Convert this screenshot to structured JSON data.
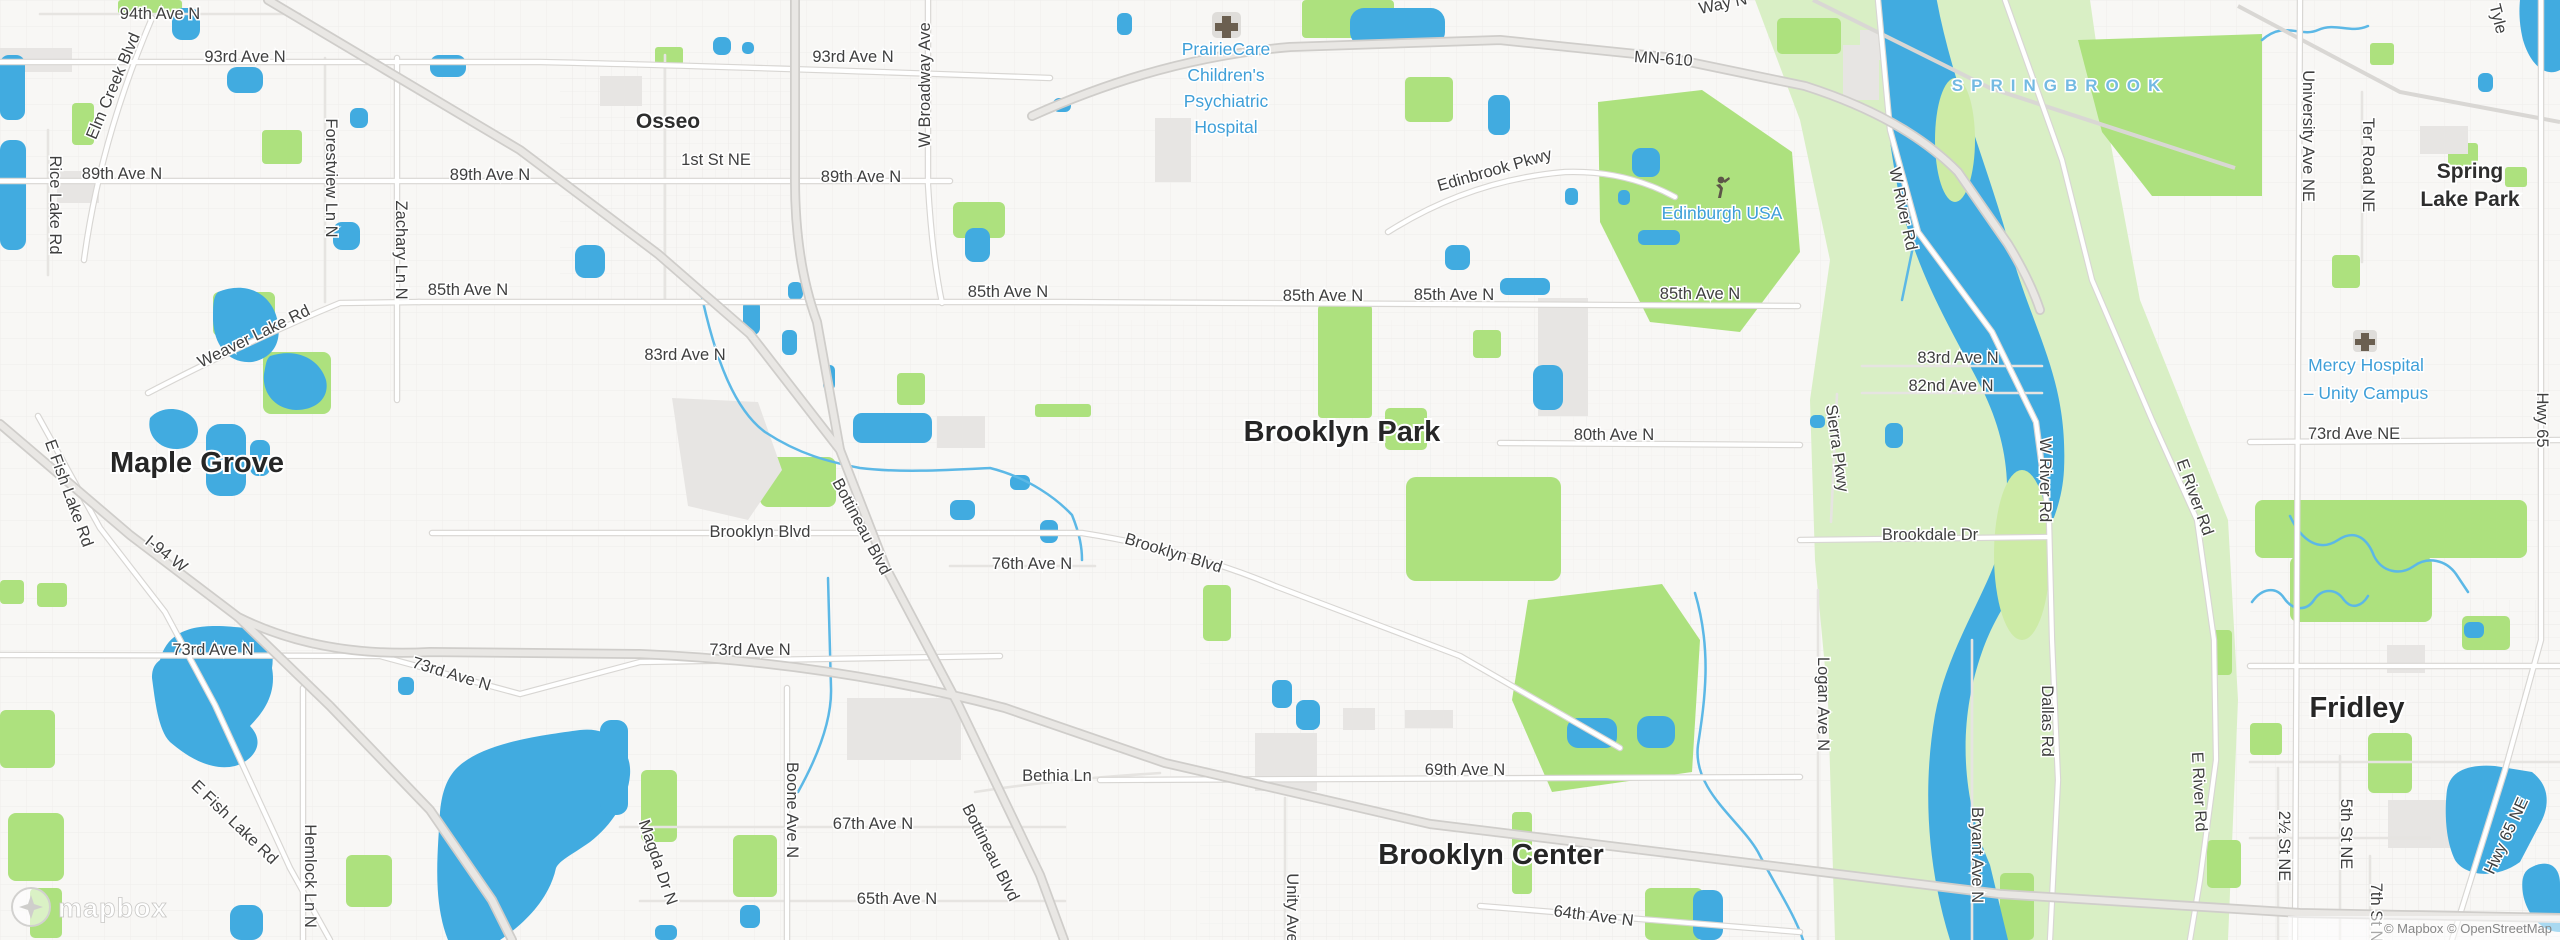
{
  "attribution": "© Mapbox © OpenStreetMap",
  "logo": "mapbox",
  "cities": {
    "maple_grove": "Maple Grove",
    "osseo": "Osseo",
    "brooklyn_park": "Brooklyn Park",
    "brooklyn_center": "Brooklyn Center",
    "fridley": "Fridley",
    "spring_lake_park": [
      "Spring",
      "Lake Park"
    ]
  },
  "pois": {
    "prairiecare": [
      "PrairieCare",
      "Children's",
      "Psychiatric",
      "Hospital"
    ],
    "edinburgh_usa": "Edinburgh USA",
    "mercy_hospital": [
      "Mercy Hospital",
      "– Unity Campus"
    ],
    "springbrook": "SPRINGBROOK"
  },
  "roads": {
    "ave94": "94th Ave N",
    "ave93": [
      "93rd Ave N",
      "93rd Ave N"
    ],
    "ave89": [
      "89th Ave N",
      "89th Ave N",
      "89th Ave N"
    ],
    "ave85": [
      "85th Ave N",
      "85th Ave N",
      "85th Ave N",
      "85th Ave N",
      "85th Ave N"
    ],
    "ave83": [
      "83rd Ave N",
      "83rd Ave N"
    ],
    "ave82": "82nd Ave N",
    "ave80": "80th Ave N",
    "ave76": "76th Ave N",
    "ave73": [
      "73rd Ave N",
      "73rd Ave N",
      "73rd Ave N"
    ],
    "ave73ne": "73rd Ave NE",
    "ave69": "69th Ave N",
    "ave67": "67th Ave N",
    "ave65": "65th Ave N",
    "ave64": "64th Ave N",
    "first_st_ne": "1st St NE",
    "elm_creek_blvd": "Elm Creek Blvd",
    "rice_lake_rd": "Rice Lake Rd",
    "forestview_ln": "Forestview Ln N",
    "zachary_ln": "Zachary Ln N",
    "weaver_lake_rd": "Weaver Lake Rd",
    "e_fish_lake_rd": [
      "E Fish Lake Rd",
      "E Fish Lake Rd"
    ],
    "i94_w": "I-94 W",
    "hemlock_ln": "Hemlock Ln N",
    "magda_dr": "Magda Dr N",
    "boone_ave": "Boone Ave N",
    "bethia_ln": "Bethia Ln",
    "bottineau_blvd": [
      "Bottineau Blvd",
      "Bottineau Blvd"
    ],
    "brooklyn_blvd": [
      "Brooklyn Blvd",
      "Brooklyn Blvd"
    ],
    "w_broadway_ave": "W Broadway Ave",
    "mn610": "MN-610",
    "edinbrook_pkwy": "Edinbrook Pkwy",
    "w_river_rd": [
      "W River Rd",
      "W River Rd"
    ],
    "e_river_rd": [
      "E River Rd",
      "E River Rd"
    ],
    "sierra_pkwy": "Sierra Pkwy",
    "brookdale_dr": "Brookdale Dr",
    "logan_ave": "Logan Ave N",
    "bryant_ave": "Bryant Ave N",
    "dallas_rd": "Dallas Rd",
    "unity_ave": "Unity Ave",
    "university_ave_ne": "University Ave NE",
    "ter_road_ne": "Ter Road NE",
    "hwy65": "Hwy 65",
    "hwy65_ne": "Hwy 65 NE",
    "st_2half_ne": "2½ St NE",
    "st_5th_ne": "5th St NE",
    "st_7th_ne": "7th St NE",
    "tyler_partial": "Tyle",
    "way_n_partial": "Way N"
  }
}
